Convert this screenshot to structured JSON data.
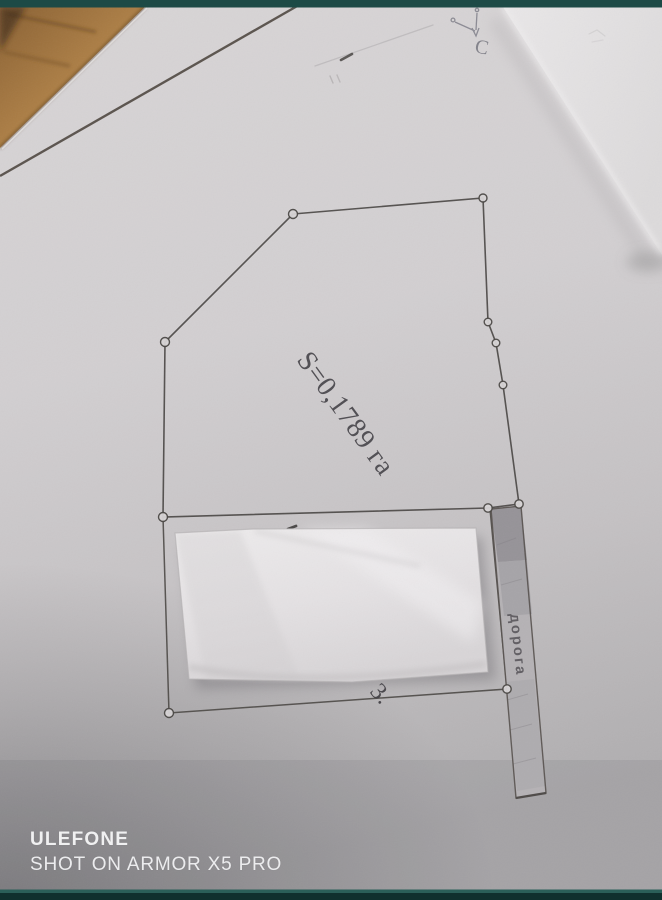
{
  "plan": {
    "area_label": "S=0,1789 га",
    "road_label": "дорога",
    "north_label": "С",
    "covered_fragment": "3."
  },
  "watermark": {
    "brand": "ULEFONE",
    "tagline": "SHOT ON ARMOR X5 PRO"
  },
  "colors": {
    "letterbox_teal": "#1d4a46",
    "paper_gray": "#d2cfd1",
    "paper_bright": "#e6e4e5",
    "paper_shadow": "#a9a7a9",
    "wood_tan": "#a87c44",
    "ink_dark": "#4a4744",
    "road_strip_gray": "#b4b1b4",
    "watermark_white": "#f0f0f1"
  }
}
